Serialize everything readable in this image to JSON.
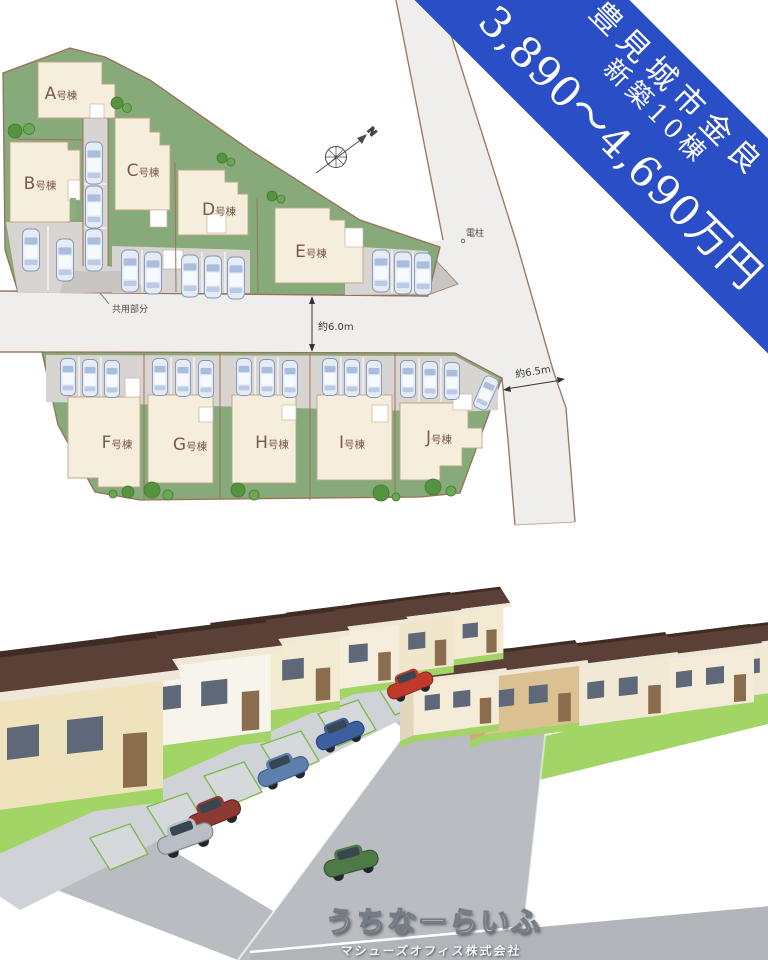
{
  "banner": {
    "location": "豊見城市金良",
    "units": "新築10棟",
    "price": "3,890〜4,690万円",
    "bg_color": "#2a4ec6",
    "text_color": "#ffffff"
  },
  "site_plan": {
    "north_label": "N",
    "pole_label": "電柱",
    "common_area_label": "共用部分",
    "road_width_between": "約6.0m",
    "road_width_east": "約6.5m",
    "lots": [
      {
        "letter": "A",
        "suffix": "号棟",
        "label": "A号棟"
      },
      {
        "letter": "B",
        "suffix": "号棟",
        "label": "B号棟"
      },
      {
        "letter": "C",
        "suffix": "号棟",
        "label": "C号棟"
      },
      {
        "letter": "D",
        "suffix": "号棟",
        "label": "D号棟"
      },
      {
        "letter": "E",
        "suffix": "号棟",
        "label": "E号棟"
      },
      {
        "letter": "F",
        "suffix": "号棟",
        "label": "F号棟"
      },
      {
        "letter": "G",
        "suffix": "号棟",
        "label": "G号棟"
      },
      {
        "letter": "H",
        "suffix": "号棟",
        "label": "H号棟"
      },
      {
        "letter": "I",
        "suffix": "号棟",
        "label": "I号棟"
      },
      {
        "letter": "J",
        "suffix": "号棟",
        "label": "J号棟"
      }
    ],
    "colors": {
      "lawn_green": "#86aa79",
      "building_cream": "#f6eedd",
      "road": "#f0eeec",
      "parking_gray": "#d8d5d2",
      "boundary_brown": "#9d7b66"
    }
  },
  "footer": {
    "brand": "うちなーらいふ",
    "company": "マシューズオフィス株式会社"
  }
}
